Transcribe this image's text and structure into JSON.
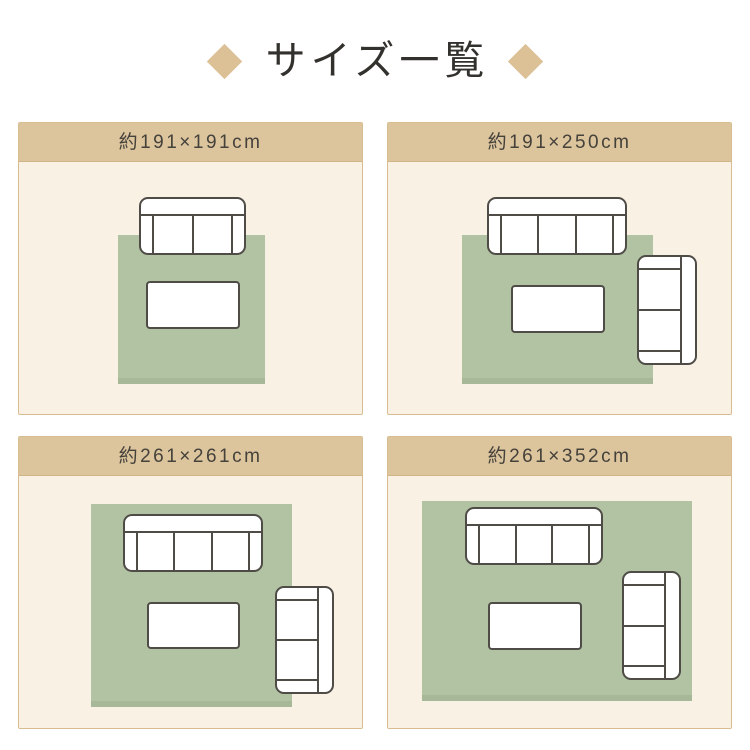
{
  "title": {
    "text": "サイズ一覧",
    "decoration": "diamond-icon"
  },
  "colors": {
    "page_background": "#ffffff",
    "accent_tan": "#dcc49d",
    "diamond_tan": "#dcc096",
    "panel_border_tan": "#d9bd92",
    "panel_cream": "#faf1e5",
    "rug_green": "#b2c3a3",
    "rug_shadow_green": "#a6b897",
    "furniture_outline": "#4f4c47",
    "title_text": "#33312e",
    "label_text": "#45423b"
  },
  "panels": [
    {
      "label": "約191×191cm",
      "rug_shape": "square",
      "furniture": [
        "rug",
        "2-seat sofa",
        "low table"
      ]
    },
    {
      "label": "約191×250cm",
      "rug_shape": "landscape rectangle",
      "furniture": [
        "rug",
        "3-seat sofa",
        "low table",
        "2-seat sofa (vertical)"
      ]
    },
    {
      "label": "約261×261cm",
      "rug_shape": "large square",
      "furniture": [
        "rug",
        "3-seat sofa",
        "low table",
        "2-seat sofa (vertical)"
      ]
    },
    {
      "label": "約261×352cm",
      "rug_shape": "large landscape rectangle",
      "furniture": [
        "rug",
        "3-seat sofa",
        "low table",
        "2-seat sofa (vertical)"
      ]
    }
  ]
}
